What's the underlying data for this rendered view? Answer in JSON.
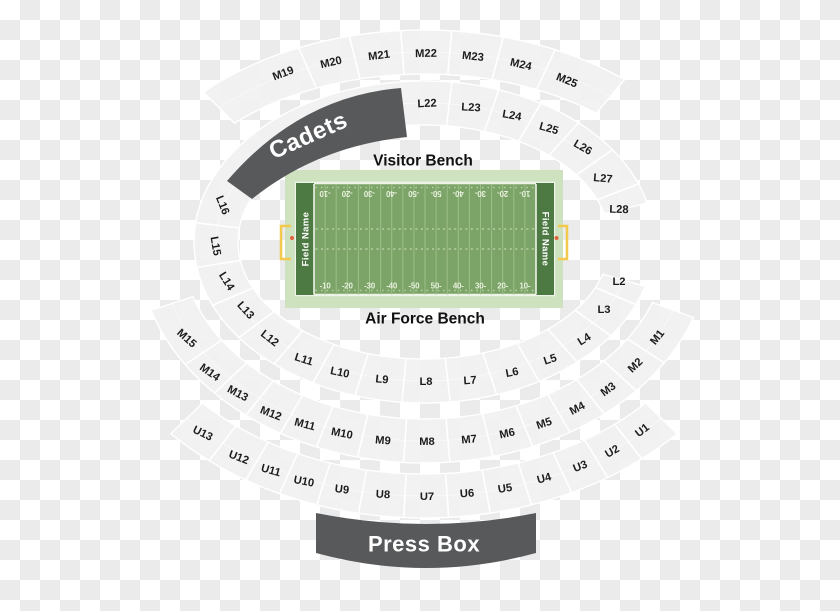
{
  "cadets": {
    "label": "Cadets"
  },
  "press_box": {
    "label": "Press Box"
  },
  "field": {
    "visitor_bench": "Visitor Bench",
    "air_force_bench": "Air Force Bench",
    "name_left": "Field Name",
    "name_right": "Field Name",
    "yard_numbers": [
      "-10",
      "-20",
      "-30",
      "-40",
      "-50",
      "50-",
      "40-",
      "30-",
      "20-",
      "10-"
    ]
  },
  "colors": {
    "checker_light": "#ffffff",
    "checker_dark": "#ebebeb",
    "band_fill": "#f1f1f1",
    "band_line": "#ffffff",
    "label_text": "#1c1c1c",
    "dark_band": "#58595b",
    "band_text": "#ffffff",
    "field_apron": "#cfe2c0",
    "field_green": "#7ca468",
    "endzone_green": "#4d7a42",
    "yard_line": "#9cbf87",
    "goal_line": "#eef4e7",
    "number_text": "#e7f0dd",
    "hash_mark": "#c3d8b0",
    "goal_post": "#f2c94d",
    "goal_dot": "#e0653a",
    "bench_text": "#111111"
  },
  "rings": [
    {
      "id": "ring-l",
      "rxIn": 186,
      "ryIn": 117,
      "rxOut": 230,
      "ryOut": 161,
      "t0": 16,
      "t1": 346,
      "labels": [
        {
          "text": "L2",
          "x": 619,
          "y": 281,
          "rot": 0
        },
        {
          "text": "L3",
          "x": 604,
          "y": 309,
          "rot": 0
        },
        {
          "text": "L4",
          "x": 584,
          "y": 339,
          "rot": -32
        },
        {
          "text": "L5",
          "x": 550,
          "y": 359,
          "rot": -18
        },
        {
          "text": "L6",
          "x": 512,
          "y": 372,
          "rot": -11
        },
        {
          "text": "L7",
          "x": 470,
          "y": 380,
          "rot": -4
        },
        {
          "text": "L8",
          "x": 426,
          "y": 381,
          "rot": 0
        },
        {
          "text": "L9",
          "x": 382,
          "y": 379,
          "rot": 6
        },
        {
          "text": "L10",
          "x": 340,
          "y": 372,
          "rot": 12
        },
        {
          "text": "L11",
          "x": 304,
          "y": 359,
          "rot": 18
        },
        {
          "text": "L12",
          "x": 270,
          "y": 338,
          "rot": 38
        },
        {
          "text": "L13",
          "x": 246,
          "y": 310,
          "rot": 48
        },
        {
          "text": "L14",
          "x": 227,
          "y": 281,
          "rot": 58
        },
        {
          "text": "L15",
          "x": 216,
          "y": 246,
          "rot": 80
        },
        {
          "text": "L16",
          "x": 223,
          "y": 205,
          "rot": 68
        },
        {
          "text": "L22",
          "x": 427,
          "y": 103,
          "rot": -3
        },
        {
          "text": "L23",
          "x": 471,
          "y": 107,
          "rot": 3
        },
        {
          "text": "L24",
          "x": 512,
          "y": 115,
          "rot": 10
        },
        {
          "text": "L25",
          "x": 549,
          "y": 128,
          "rot": 16
        },
        {
          "text": "L26",
          "x": 583,
          "y": 147,
          "rot": 30
        },
        {
          "text": "L27",
          "x": 603,
          "y": 178,
          "rot": 5
        },
        {
          "text": "L28",
          "x": 619,
          "y": 209,
          "rot": 2
        }
      ]
    },
    {
      "id": "ring-m-top",
      "rxIn": 268,
      "ryIn": 168,
      "rxOut": 312,
      "ryOut": 212,
      "t0": -135,
      "t1": -50,
      "labels": [
        {
          "text": "M19",
          "x": 283,
          "y": 73,
          "rot": -21
        },
        {
          "text": "M20",
          "x": 331,
          "y": 62,
          "rot": -13
        },
        {
          "text": "M21",
          "x": 379,
          "y": 55,
          "rot": -7
        },
        {
          "text": "M22",
          "x": 426,
          "y": 53,
          "rot": -1
        },
        {
          "text": "M23",
          "x": 473,
          "y": 56,
          "rot": 6
        },
        {
          "text": "M24",
          "x": 521,
          "y": 64,
          "rot": 13
        },
        {
          "text": "M25",
          "x": 567,
          "y": 80,
          "rot": 22
        }
      ]
    },
    {
      "id": "ring-m-bottom",
      "rxIn": 243,
      "ryIn": 177,
      "rxOut": 287,
      "ryOut": 221,
      "t0": 20,
      "t1": 162,
      "labels": [
        {
          "text": "M1",
          "x": 657,
          "y": 337,
          "rot": -52
        },
        {
          "text": "M2",
          "x": 635,
          "y": 365,
          "rot": -44
        },
        {
          "text": "M3",
          "x": 608,
          "y": 389,
          "rot": -36
        },
        {
          "text": "M4",
          "x": 577,
          "y": 408,
          "rot": -28
        },
        {
          "text": "M5",
          "x": 544,
          "y": 423,
          "rot": -19
        },
        {
          "text": "M6",
          "x": 507,
          "y": 433,
          "rot": -12
        },
        {
          "text": "M7",
          "x": 469,
          "y": 439,
          "rot": -5
        },
        {
          "text": "M8",
          "x": 427,
          "y": 441,
          "rot": 0
        },
        {
          "text": "M9",
          "x": 383,
          "y": 440,
          "rot": 5
        },
        {
          "text": "M10",
          "x": 342,
          "y": 433,
          "rot": 11
        },
        {
          "text": "M11",
          "x": 305,
          "y": 424,
          "rot": 15
        },
        {
          "text": "M12",
          "x": 271,
          "y": 413,
          "rot": 21
        },
        {
          "text": "M13",
          "x": 238,
          "y": 393,
          "rot": 28
        },
        {
          "text": "M14",
          "x": 210,
          "y": 372,
          "rot": 35
        },
        {
          "text": "M15",
          "x": 187,
          "y": 338,
          "rot": 42
        }
      ]
    },
    {
      "id": "ring-u",
      "rxIn": 308,
      "ryIn": 232,
      "rxOut": 352,
      "ryOut": 276,
      "t0": 44,
      "t1": 136,
      "labels": [
        {
          "text": "U1",
          "x": 642,
          "y": 430,
          "rot": -38
        },
        {
          "text": "U2",
          "x": 612,
          "y": 451,
          "rot": -30
        },
        {
          "text": "U3",
          "x": 580,
          "y": 466,
          "rot": -22
        },
        {
          "text": "U4",
          "x": 544,
          "y": 478,
          "rot": -15
        },
        {
          "text": "U5",
          "x": 505,
          "y": 488,
          "rot": -9
        },
        {
          "text": "U6",
          "x": 467,
          "y": 493,
          "rot": -4
        },
        {
          "text": "U7",
          "x": 427,
          "y": 496,
          "rot": 0
        },
        {
          "text": "U8",
          "x": 383,
          "y": 494,
          "rot": 3
        },
        {
          "text": "U9",
          "x": 342,
          "y": 489,
          "rot": 7
        },
        {
          "text": "U10",
          "x": 304,
          "y": 481,
          "rot": 11
        },
        {
          "text": "U11",
          "x": 271,
          "y": 470,
          "rot": 16
        },
        {
          "text": "U12",
          "x": 239,
          "y": 457,
          "rot": 21
        },
        {
          "text": "U13",
          "x": 203,
          "y": 433,
          "rot": 26
        }
      ]
    }
  ]
}
